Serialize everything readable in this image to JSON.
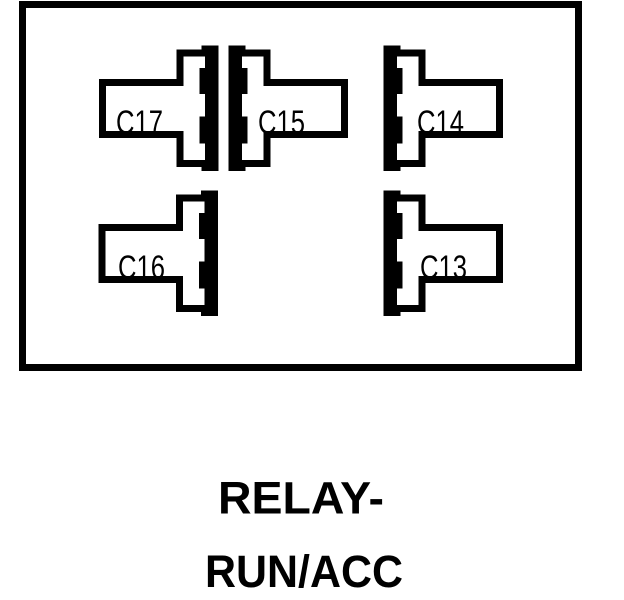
{
  "diagram": {
    "type": "relay-connector-face-diagram",
    "caption": {
      "line1": "RELAY-",
      "line2": "RUN/ACC"
    },
    "connectors": [
      {
        "id": "c17",
        "label": "C17",
        "row": "top",
        "facing": "right"
      },
      {
        "id": "c15",
        "label": "C15",
        "row": "top",
        "facing": "left"
      },
      {
        "id": "c14",
        "label": "C14",
        "row": "top",
        "facing": "left"
      },
      {
        "id": "c16",
        "label": "C16",
        "row": "bottom",
        "facing": "right"
      },
      {
        "id": "c13",
        "label": "C13",
        "row": "bottom",
        "facing": "left"
      }
    ],
    "colors": {
      "line": "#000000",
      "background": "#ffffff"
    }
  }
}
